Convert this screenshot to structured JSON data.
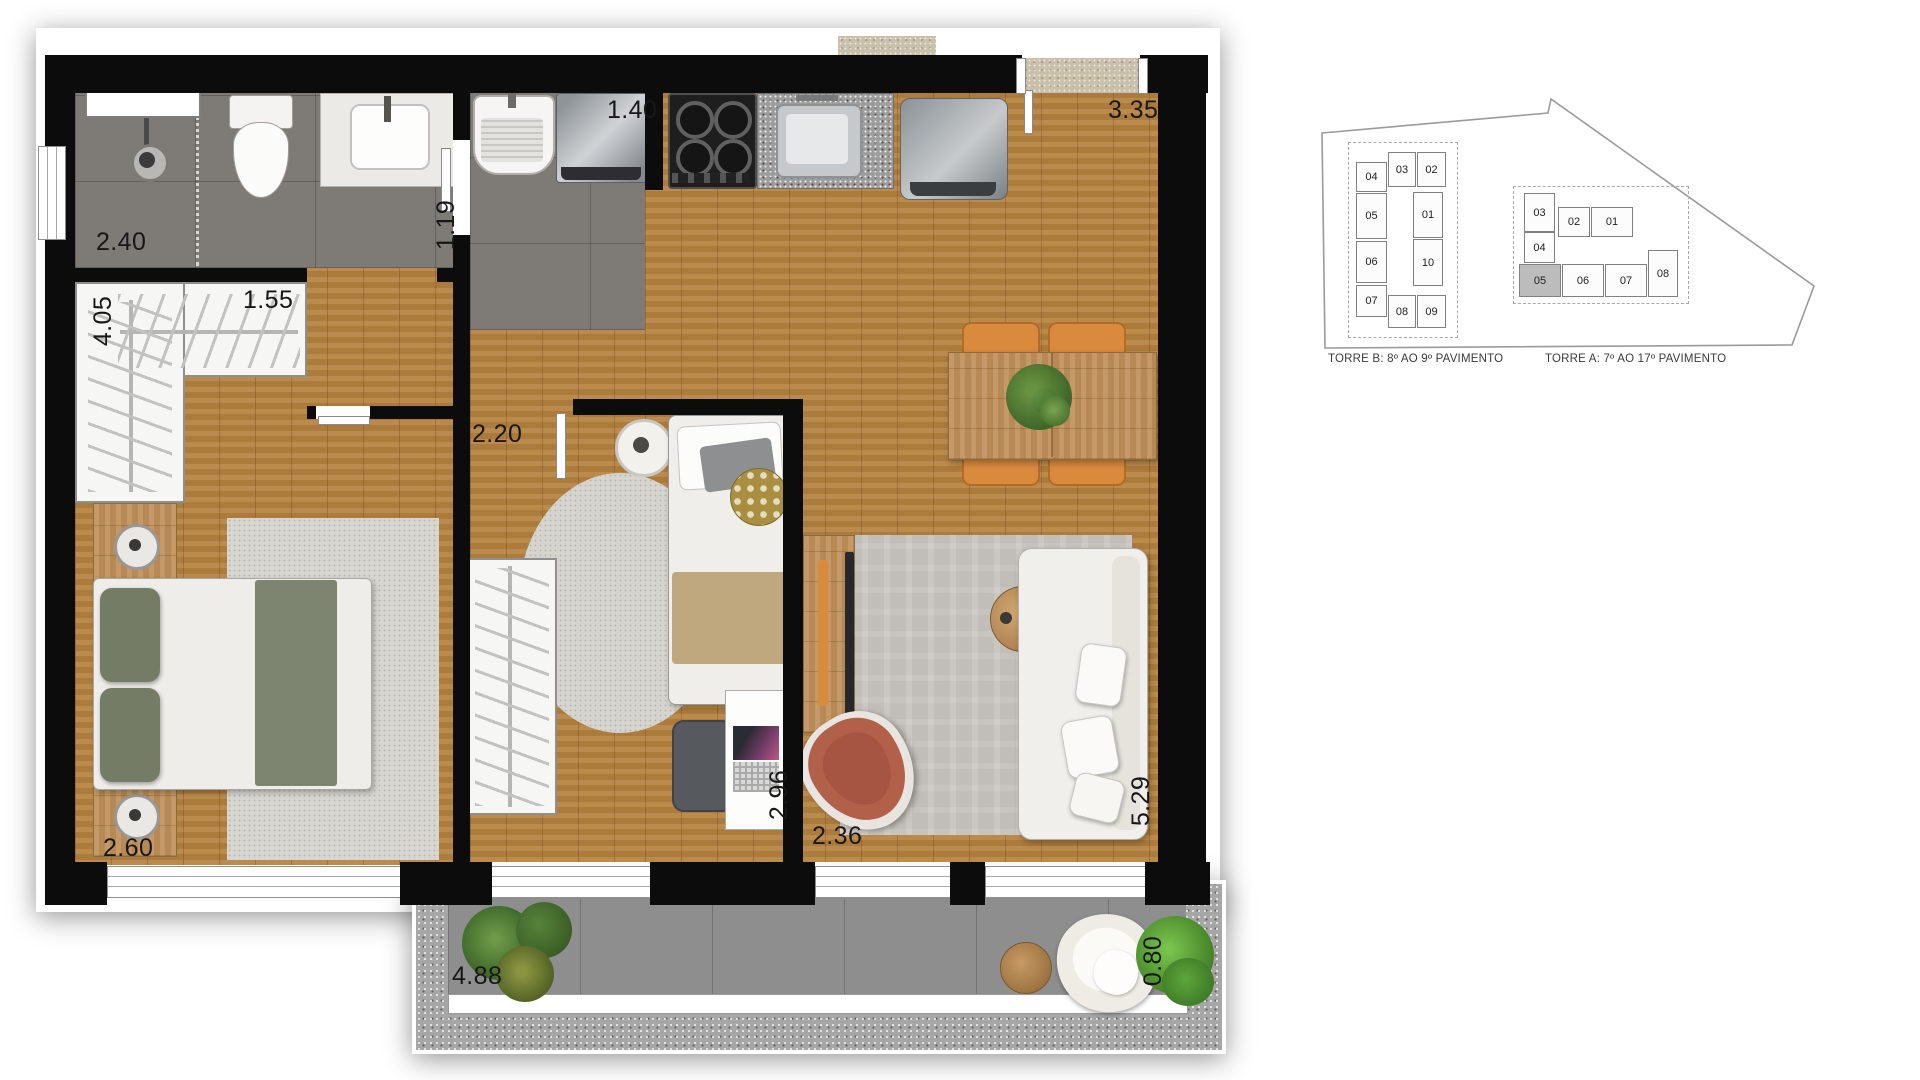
{
  "floorplan": {
    "dimensions": {
      "bath_width": "2.40",
      "bath_depth": "1.19",
      "closet_length": "4.05",
      "closet_width": "1.55",
      "laundry_width": "1.40",
      "dining_width": "3.35",
      "office_door": "2.20",
      "office_depth": "2.96",
      "living_width": "2.36",
      "living_depth": "5.29",
      "bedroom_width": "2.60",
      "balcony_width": "4.88",
      "balcony_depth": "0.80"
    }
  },
  "keyplan": {
    "torre_b": {
      "label": "TORRE B: 8º AO 9º PAVIMENTO",
      "units": [
        "04",
        "03",
        "02",
        "05",
        "01",
        "06",
        "10",
        "07",
        "08",
        "09"
      ]
    },
    "torre_a": {
      "label": "TORRE A: 7º AO 17º PAVIMENTO",
      "units": [
        "03",
        "02",
        "01",
        "04",
        "05",
        "06",
        "07",
        "08"
      ],
      "highlighted_unit": "05"
    }
  },
  "colors": {
    "wall": "#0c0c0c",
    "wood_floor": "#b5823f",
    "highlight_unit": "#bcbcbc",
    "dining_chair": "#d98a3c",
    "armchair": "#b2604a",
    "bedding_green": "#79806a",
    "blanket_tan": "#bfa87e"
  }
}
